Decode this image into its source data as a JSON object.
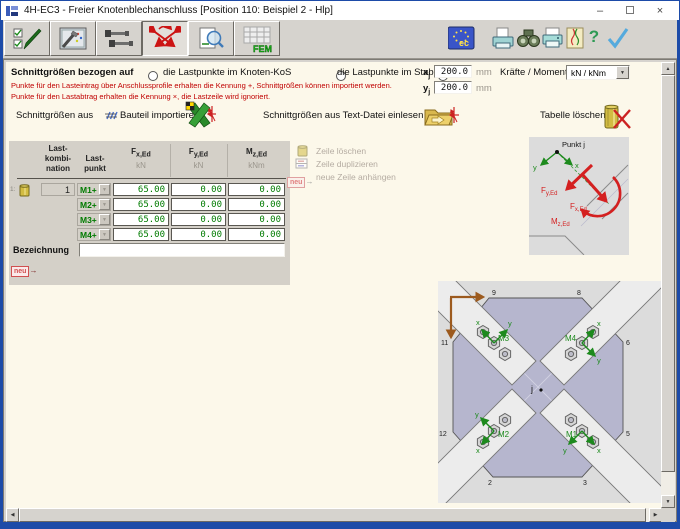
{
  "window": {
    "title": "4H-EC3 - Freier Knotenblechanschluss [Position 110: Beispiel 2 - Hlp]",
    "minimize_glyph": "–",
    "close_glyph": "×"
  },
  "toolbar": {
    "fem_label": "FEM",
    "ec_label": "ec"
  },
  "icons": {
    "scroll_up": "▲",
    "scroll_down": "▼",
    "scroll_left": "◀",
    "scroll_right": "▶",
    "dropdown": "▼",
    "neu_arrow": "→",
    "help": "?",
    "confirm": "✓"
  },
  "controls": {
    "section_label": "Schnittgrößen bezogen auf",
    "radio_knoten_label": "die Lastpunkte im Knoten-KoS",
    "radio_stab_label": "die Lastpunkte im Stab-KoS",
    "x_label_main": "x",
    "x_label_sub": "j",
    "x_value": "200.0",
    "x_unit": "mm",
    "y_label_main": "y",
    "y_label_sub": "j",
    "y_value": "200.0",
    "y_unit": "mm",
    "note_line1": "Punkte für den Lasteintrag über Anschlussprofile erhalten die Kennung +, Schnittgrößen können importiert werden.",
    "note_line2": "Punkte für den Lastabtrag erhalten die Kennung ×, die Lastzeile wird ignoriert.",
    "units_label": "Kräfte / Momente in",
    "units_value": "kN / kNm",
    "import_member_prefix": "Schnittgrößen aus",
    "import_member_suffix": "Bauteil importieren",
    "import_textfile_label": "Schnittgrößen aus Text-Datei einlesen",
    "clear_table_label": "Tabelle löschen"
  },
  "table": {
    "row_number": "1:",
    "header_komb_l1": "Last-",
    "header_komb_l2": "kombi-",
    "header_komb_l3": "nation",
    "header_punkt_l1": "Last-",
    "header_punkt_l2": "punkt",
    "header_fx_main": "F",
    "header_fx_sub": "x,Ed",
    "header_fx_unit": "kN",
    "header_fy_main": "F",
    "header_fy_sub": "y,Ed",
    "header_fy_unit": "kN",
    "header_mz_main": "M",
    "header_mz_sub": "z,Ed",
    "header_mz_unit": "kNm",
    "rows": [
      {
        "kombination": "1",
        "punkt": "M1+",
        "fx": "65.00",
        "fy": "0.00",
        "mz": "0.00"
      },
      {
        "kombination": "",
        "punkt": "M2+",
        "fx": "65.00",
        "fy": "0.00",
        "mz": "0.00"
      },
      {
        "kombination": "",
        "punkt": "M3+",
        "fx": "65.00",
        "fy": "0.00",
        "mz": "0.00"
      },
      {
        "kombination": "",
        "punkt": "M4+",
        "fx": "65.00",
        "fy": "0.00",
        "mz": "0.00"
      }
    ],
    "bezeichnung_label": "Bezeichnung",
    "bezeichnung_value": "",
    "neu_label": "neu"
  },
  "legend": {
    "delete_label": "Zeile löschen",
    "duplicate_label": "Zeile duplizieren",
    "append_label": "neue Zeile anhängen",
    "neu_label": "neu"
  },
  "point_diagram": {
    "title": "Punkt j",
    "axis_x": "x",
    "axis_y": "y",
    "fy_main": "F",
    "fy_sub": "y,Ed",
    "fx_main": "F",
    "fx_sub": "x,Ed",
    "mz_main": "M",
    "mz_sub": "z,Ed"
  },
  "plate_diagram": {
    "center_label": "j",
    "m1": "M1",
    "m2": "M2",
    "m3": "M3",
    "m4": "M4",
    "axis_x": "x",
    "axis_y": "y",
    "corners": {
      "c2": "2",
      "c3": "3",
      "c5": "5",
      "c6": "6",
      "c8": "8",
      "c9": "9",
      "c11": "11",
      "c12": "12"
    }
  },
  "colors": {
    "window_border": "#1d4ba8",
    "toolbar_bg": "#d6d3ce",
    "content_bg": "#fcf8ea",
    "table_bg": "#d4d0c8",
    "value_green": "#007b00",
    "note_red": "#c00000",
    "panel_gray": "#dcdcdc",
    "plate_fill": "#b6b6ce",
    "axis_green": "#1d8a1d",
    "force_red": "#d42020",
    "global_axis_brown": "#9c5a1e"
  }
}
